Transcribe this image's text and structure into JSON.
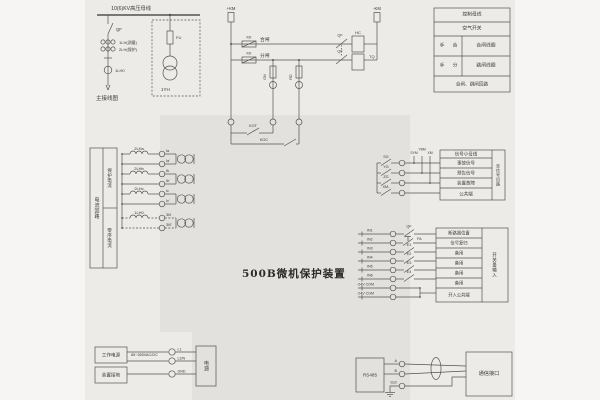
{
  "colors": {
    "page_band": "#edebe8",
    "device_region": "#e2e1de",
    "line": "#54524e",
    "text": "#3b3935"
  },
  "title": "500B微机保护装置",
  "main_diagram": {
    "busbar_label": "10(6)KV高压母线",
    "breaker": "QF",
    "ct_measure": "1LH(测量)",
    "ct_protect": "2LH(保护)",
    "ct_zero": "1LH0",
    "caption": "主接线图",
    "fuse": "FU",
    "pt": "1YH"
  },
  "control": {
    "pos_bus": "+KM",
    "neg_bus": "-KM",
    "kk": "KK",
    "close_label": "合闸",
    "open_label": "分闸",
    "qf_aux": "QF",
    "close_coil": "HC",
    "trip_coil": "TQ",
    "green_lamp": "GN",
    "red_lamp": "RD",
    "trip_out": "KOT",
    "close_out": "KOC"
  },
  "control_table": {
    "header1": "控制母线",
    "header2": "空气开关",
    "row_close": {
      "hand": "手",
      "action": "合",
      "coil": "合闸线圈"
    },
    "row_open": {
      "hand": "手",
      "action": "分",
      "coil": "跳闸线圈"
    },
    "footer": "合闸、跳闸回路"
  },
  "current_section": {
    "col_loop": "电流回路",
    "col_protect": "保护电流",
    "col_zero": "零序电流",
    "phases": [
      {
        "winding": "2LHa",
        "t1": "Ia",
        "t2": "Ia'"
      },
      {
        "winding": "2LHb",
        "t1": "Ib",
        "t2": "Ib'"
      },
      {
        "winding": "2LHc",
        "t1": "Ic",
        "t2": "Ic'"
      },
      {
        "winding": "1LH0",
        "t1": "3I0",
        "t2": "3I0'"
      }
    ]
  },
  "signal_section": {
    "buses": [
      "SYM",
      "YBM",
      "XM"
    ],
    "contacts": [
      "SG",
      "YG",
      "ZG",
      "XM-"
    ],
    "table": [
      "信号小母线",
      "事故信号",
      "预告信号",
      "装置故障",
      "公共端"
    ],
    "side_label": "至信号回路"
  },
  "input_section": {
    "rows": [
      {
        "label": "IN1",
        "contact": "QF"
      },
      {
        "label": "IN2",
        "contact": "FA"
      },
      {
        "label": "IN3",
        "contact": "E1"
      },
      {
        "label": "IN4",
        "contact": "E2"
      },
      {
        "label": "IN5",
        "contact": "E3"
      },
      {
        "label": "IN6",
        "contact": "E4"
      },
      {
        "label": "-24V COM"
      },
      {
        "label": "-24V COM"
      }
    ],
    "table": [
      "断路器位置",
      "信号复归",
      "备用",
      "备用",
      "备用",
      "备用",
      "开入公共端"
    ],
    "side_label": "开关量输入"
  },
  "power_section": {
    "work_power": "工作电源",
    "ground": "装置接地",
    "voltage": "85~265VAC/DC",
    "terminals": [
      "L1",
      "L2/N",
      "GND"
    ],
    "box": "电源"
  },
  "comm_section": {
    "box": "RS485",
    "terminals": [
      "A",
      "B",
      "SLD"
    ],
    "interface": "通信接口"
  }
}
